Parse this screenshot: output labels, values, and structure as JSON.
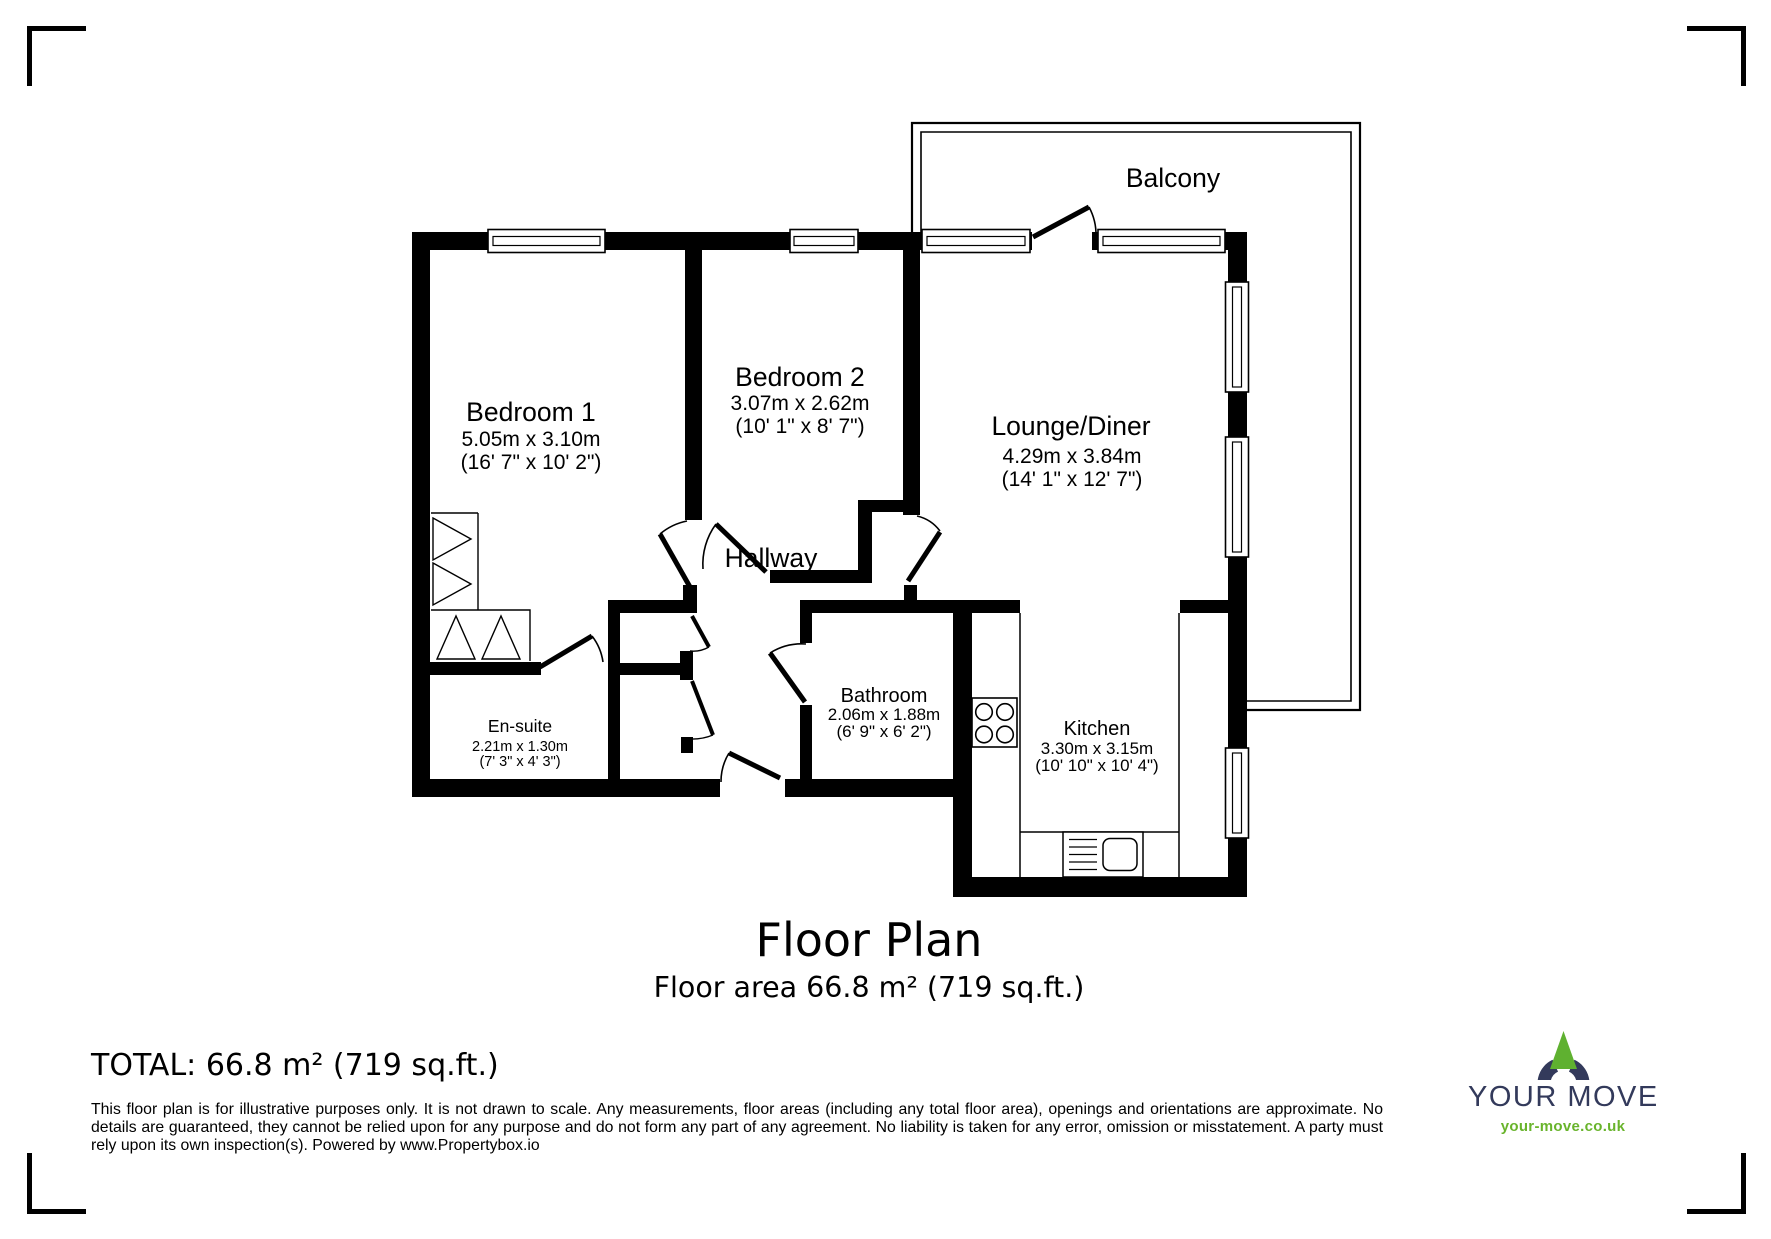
{
  "plan": {
    "title": "Floor Plan",
    "subtitle": "Floor area 66.8 m² (719 sq.ft.)",
    "rooms": {
      "bedroom1": {
        "name": "Bedroom 1",
        "metric": "5.05m x 3.10m",
        "imperial": "(16' 7\" x 10' 2\")"
      },
      "bedroom2": {
        "name": "Bedroom 2",
        "metric": "3.07m x 2.62m",
        "imperial": "(10' 1\" x 8' 7\")"
      },
      "lounge": {
        "name": "Lounge/Diner",
        "metric": "4.29m x 3.84m",
        "imperial": "(14' 1\" x 12' 7\")"
      },
      "hallway": {
        "name": "Hallway"
      },
      "balcony": {
        "name": "Balcony"
      },
      "ensuite": {
        "name": "En-suite",
        "metric": "2.21m x 1.30m",
        "imperial": "(7' 3\" x 4' 3\")"
      },
      "bathroom": {
        "name": "Bathroom",
        "metric": "2.06m x 1.88m",
        "imperial": "(6' 9\" x 6' 2\")"
      },
      "kitchen": {
        "name": "Kitchen",
        "metric": "3.30m x 3.15m",
        "imperial": "(10' 10\" x 10' 4\")"
      }
    }
  },
  "footer": {
    "total": "TOTAL: 66.8 m² (719 sq.ft.)",
    "disclaimer": "This floor plan is for illustrative purposes only. It is not drawn to scale. Any measurements, floor areas (including any total floor area), openings and orientations are approximate. No details are guaranteed, they cannot be relied upon for any purpose and do not form any part of any agreement. No liability is taken for any error, omission or misstatement. A party must rely upon its own inspection(s). Powered by www.Propertybox.io"
  },
  "logo": {
    "brand": "YOUR MOVE",
    "url": "your-move.co.uk",
    "navy": "#333a5b",
    "green": "#5fb130"
  }
}
